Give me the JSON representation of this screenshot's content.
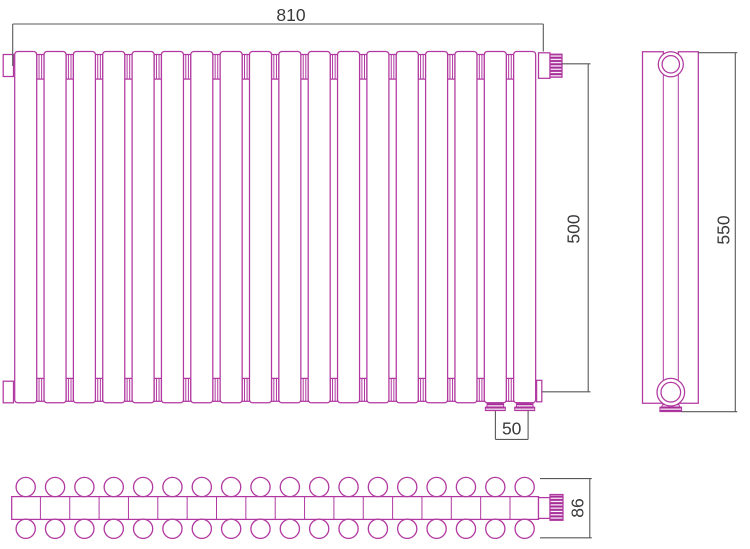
{
  "drawing": {
    "type": "technical-drawing",
    "subject": "sectional tubular radiator, three orthographic views",
    "radiator": {
      "sections": 18,
      "tube_rows": 2,
      "bottom_connections": 2
    },
    "dimensions": {
      "width": "810",
      "height": "500",
      "connection_spacing": "50",
      "overall_height": "550",
      "depth": "86"
    },
    "colors": {
      "line": "#b138a0",
      "accent_fill": "#a62c98",
      "dim_line": "#58585a",
      "dim_text": "#3a3a3d",
      "background": "#ffffff"
    }
  }
}
